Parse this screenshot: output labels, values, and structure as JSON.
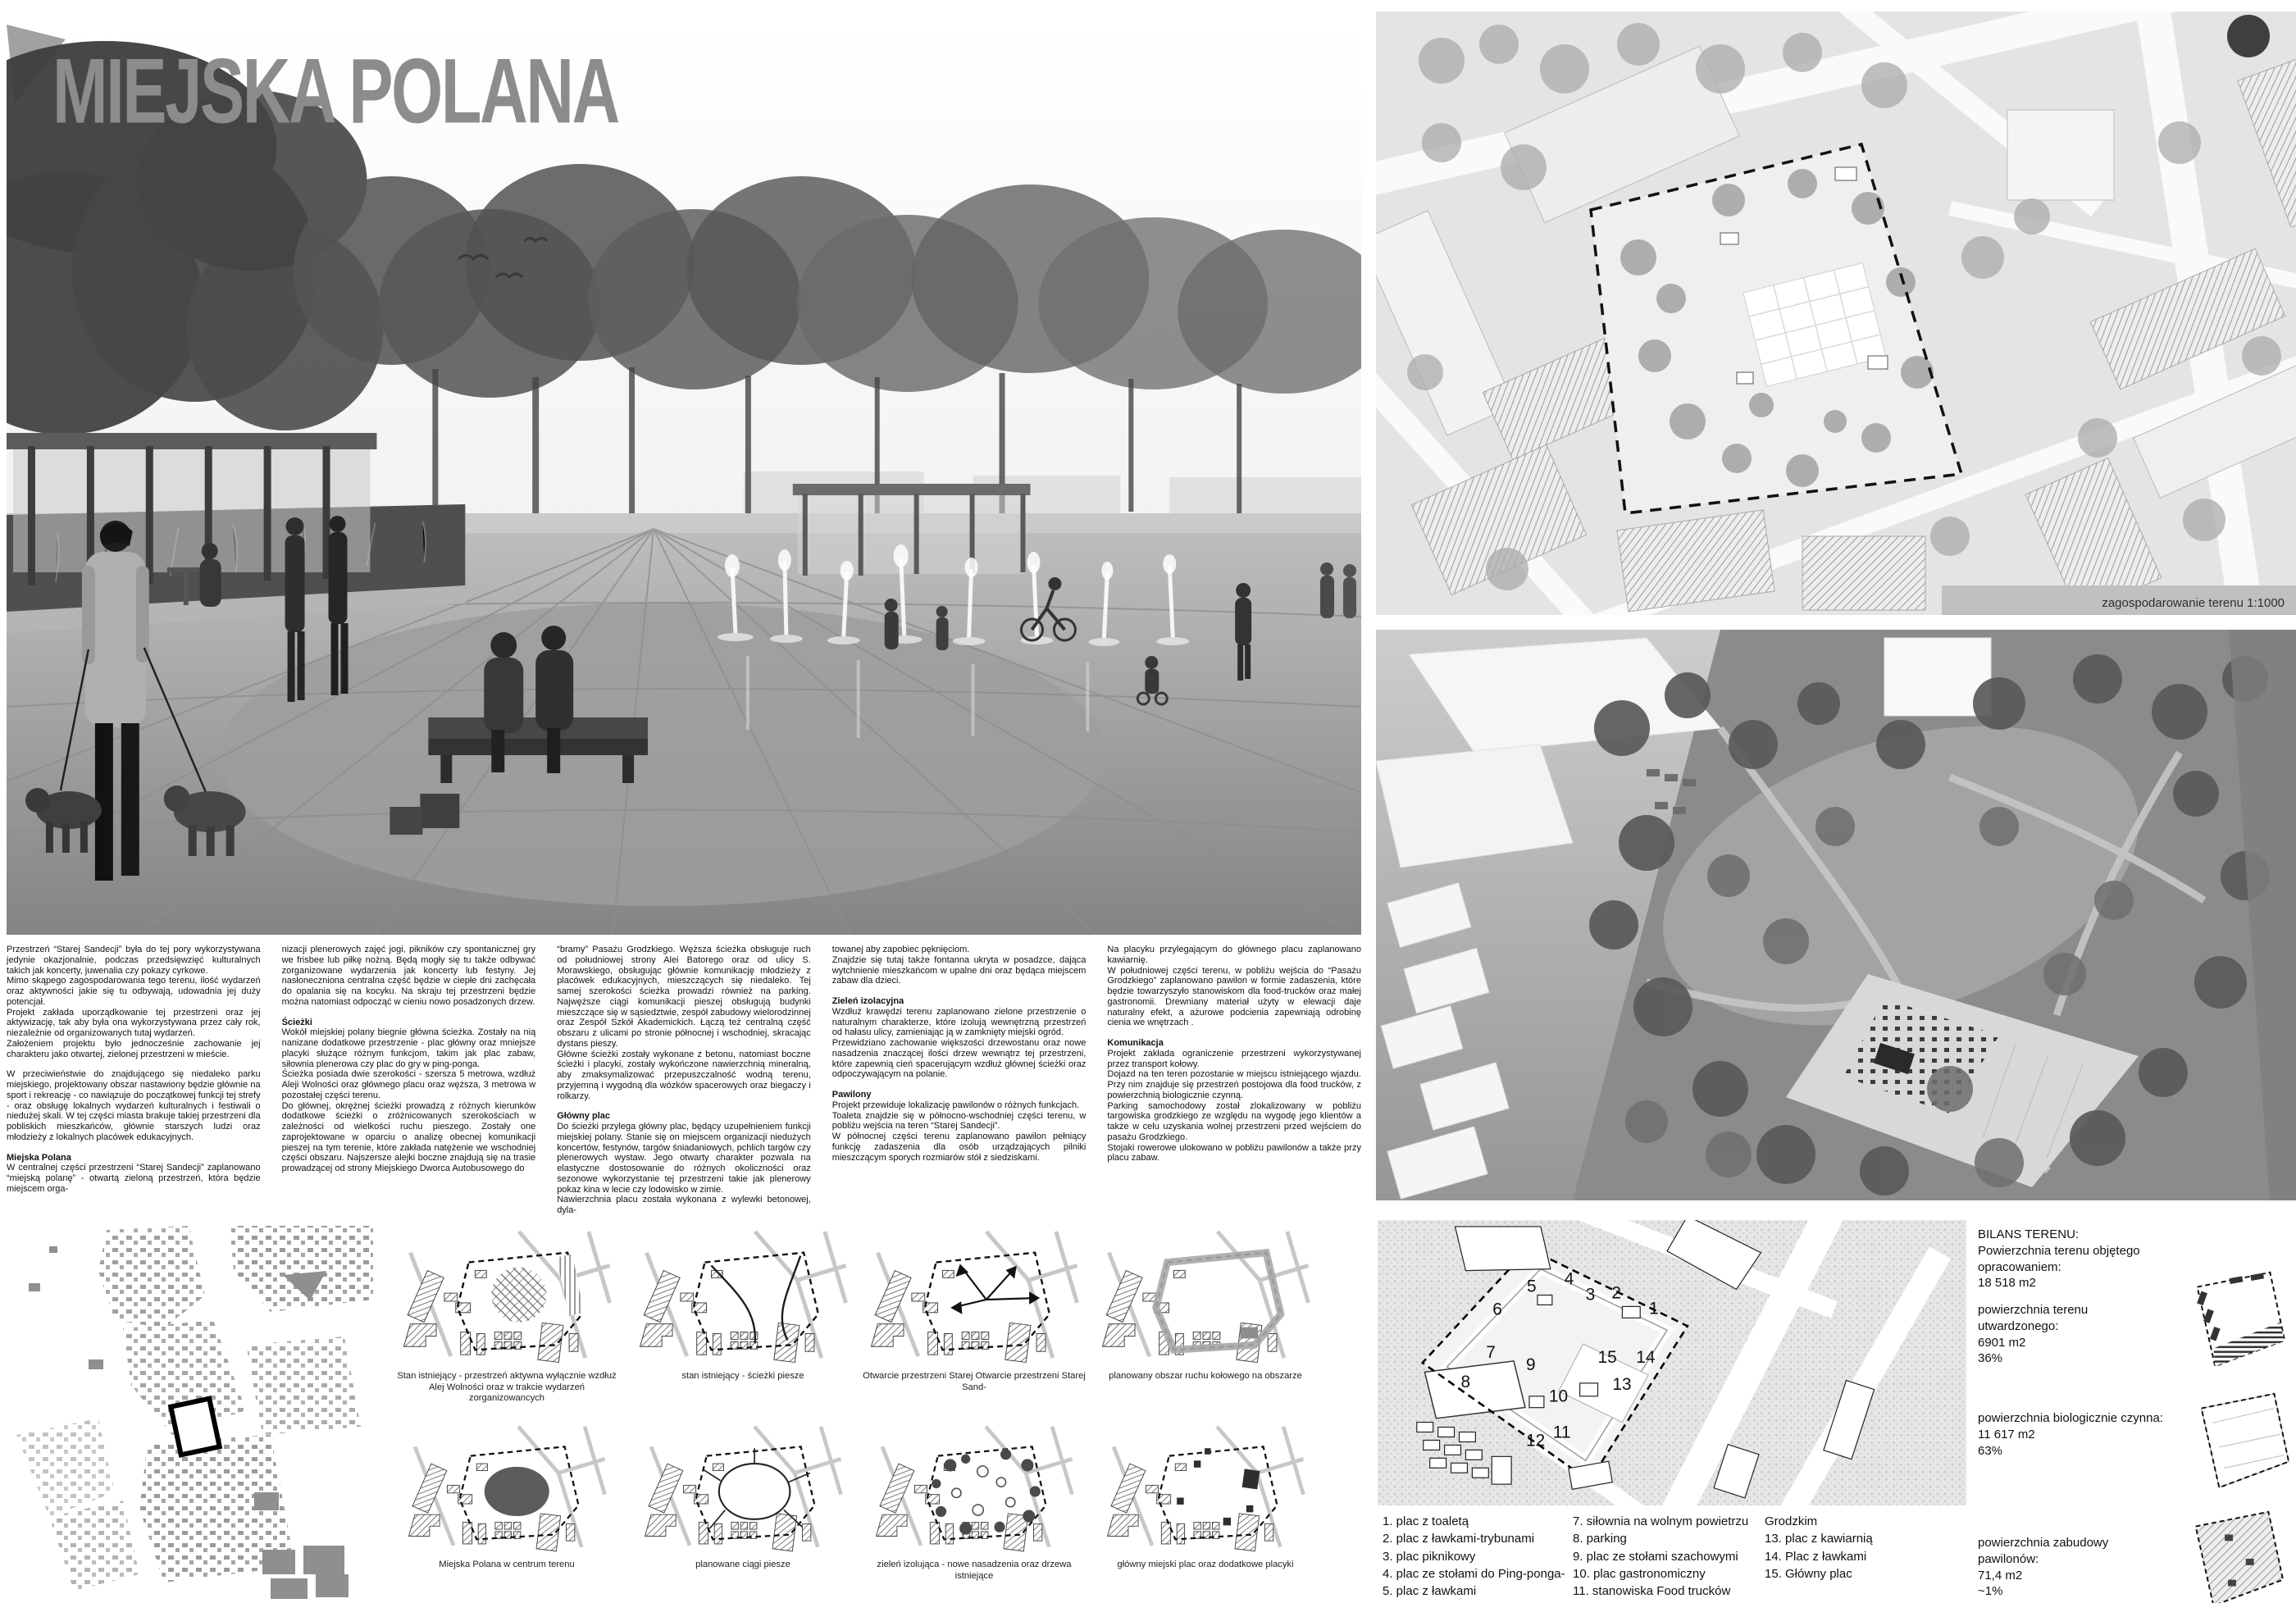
{
  "board": {
    "title": "MIEJSKA POLANA"
  },
  "narrative": {
    "col1": {
      "blocks": [
        {
          "text": "Przestrzeń “Starej Sandecji” była do tej pory wykorzystywana jedynie okazjonalnie, podczas przedsięwzięć kulturalnych takich jak koncerty, juwenalia czy pokazy cyrkowe."
        },
        {
          "text": "Mimo skąpego zagospodarowania tego terenu, ilość wydarzeń oraz aktywności jakie się tu odbywają, udowadnia jej duży potencjał."
        },
        {
          "text": "Projekt zakłada uporządkowanie tej przestrzeni oraz jej aktywizację, tak aby była ona wykorzystywana przez cały rok, niezależnie od organizowanych tutaj wydarzeń."
        },
        {
          "text": "Założeniem projektu było jednocześnie zachowanie jej charakteru jako otwartej, zielonej przestrzeni w mieście."
        },
        {
          "text": "W przeciwieństwie do znajdującego się niedaleko parku miejskiego, projektowany obszar nastawiony będzie głównie na sport i rekreację - co nawiązuje do początkowej funkcji tej strefy - oraz obsługę lokalnych wydarzeń kulturalnych i festiwali o niedużej skali. W tej części miasta brakuje takiej przestrzeni dla pobliskich mieszkańców, głównie starszych ludzi oraz młodzieży z lokalnych placówek edukacyjnych."
        },
        {
          "text": "Miejska Polana"
        },
        {
          "text": "W centralnej części przestrzeni “Starej Sandecji” zaplanowano “miejską polanę” - otwartą zieloną przestrzeń, która będzie miejscem orga-"
        }
      ]
    },
    "col2": {
      "blocks": [
        {
          "text": "nizacji plenerowych zajęć jogi, pikników czy spontanicznej gry we frisbee lub piłkę nożną. Będą mogły się tu także odbywać zorganizowane wydarzenia jak koncerty lub festyny. Jej nasłoneczniona centralna część będzie w ciepłe dni zachęcała do opalania się na kocyku. Na skraju tej przestrzeni będzie można natomiast odpocząć w cieniu nowo posadzonych drzew."
        },
        {
          "text": "Ścieżki"
        },
        {
          "text": "Wokół miejskiej polany biegnie główna ścieżka. Zostały na nią nanizane dodatkowe przestrzenie - plac główny oraz mniejsze placyki służące różnym funkcjom, takim jak plac zabaw, siłownia plenerowa czy plac do gry w ping-ponga."
        },
        {
          "text": "Ścieżka posiada dwie szerokości - szersza 5 metrowa, wzdłuż Aleji Wolności oraz głównego placu oraz węższa, 3 metrowa w pozostałej części terenu."
        },
        {
          "text": "Do głównej, okrężnej ścieżki prowadzą z różnych kierunków dodatkowe ścieżki o zróżnicowanych szerokościach w zależności od wielkości ruchu pieszego. Zostały one zaprojektowane w oparciu o analizę obecnej komunikacji pieszej na tym terenie, które zakłada natężenie we wschodniej części obszaru. Najszersze alejki boczne znajdują się na trasie prowadzącej od strony Miejskiego Dworca Autobusowego do"
        }
      ]
    },
    "col3": {
      "blocks": [
        {
          "text": "“bramy” Pasażu Grodzkiego. Węższa ścieżka obsługuje ruch od południowej strony Alei Batorego oraz od ulicy S. Morawskiego, obsługując głównie komunikację młodzieży z placówek edukacyjnych, mieszczących się niedaleko. Tej samej szerokości ścieżka prowadzi również na parking. Najwęższe ciągi komunikacji pieszej obsługują budynki mieszczące się w sąsiedztwie, zespół zabudowy wielorodzinnej oraz Zespół Szkół Akademickich. Łączą też centralną część obszaru z ulicami po stronie północnej i wschodniej, skracając dystans pieszy."
        },
        {
          "text": "Główne ścieżki zostały wykonane z betonu, natomiast boczne ścieżki i placyki, zostały wykończone nawierzchnią mineralną, aby zmaksymalizować przepuszczalność wodną terenu, przyjemną i wygodną dla wózków spacerowych oraz biegaczy i rolkarzy."
        },
        {
          "text": "Główny plac"
        },
        {
          "text": "Do ścieżki przylega główny plac, będący uzupełnieniem funkcji miejskiej polany. Stanie się on miejscem organizacji niedużych koncertów, festynów, targów śniadaniowych, pchlich targów czy plenerowych wystaw. Jego otwarty charakter pozwala na elastyczne dostosowanie do różnych okoliczności oraz sezonowe wykorzystanie tej przestrzeni takie jak plenerowy pokaz kina w lecie czy lodowisko w zimie."
        },
        {
          "text": "Nawierzchnia placu została wykonana z wylewki betonowej, dyla-"
        }
      ]
    },
    "col4": {
      "blocks": [
        {
          "text": "towanej aby zapobiec pęknięciom."
        },
        {
          "text": "Znajdzie się tutaj także fontanna ukryta w posadzce, dająca wytchnienie mieszkańcom w upalne dni oraz będąca miejscem zabaw dla dzieci."
        },
        {
          "text": "Zieleń izolacyjna"
        },
        {
          "text": "Wzdłuż krawędzi terenu  zaplanowano zielone przestrzenie o naturalnym charakterze, które izolują wewnętrzną przestrzeń od hałasu ulicy, zamieniając ją w zamknięty miejski ogród."
        },
        {
          "text": "Przewidziano zachowanie większości drzewostanu oraz nowe nasadzenia znaczącej ilości drzew wewnątrz tej przestrzeni, które zapewnią cień spacerującym wzdłuż głównej ścieżki oraz odpoczywającym na polanie."
        },
        {
          "text": "Pawilony"
        },
        {
          "text": "Projekt przewiduje lokalizację pawilonów o różnych funkcjach."
        },
        {
          "text": "Toaleta znajdzie się w północno-wschodniej części terenu, w pobliżu wejścia na teren “Starej Sandecji”."
        },
        {
          "text": "W północnej części terenu zaplanowano pawilon pełniący funkcję zadaszenia dla osób urządzających pilniki mieszczącym sporych rozmiarów stół z siedziskami."
        }
      ]
    },
    "col5": {
      "blocks": [
        {
          "text": "Na placyku przylegającym do głównego placu zaplanowano kawiarnię."
        },
        {
          "text": "W południowej części terenu, w pobliżu wejścia do “Pasażu Grodzkiego” zaplanowano pawilon w formie zadaszenia, które będzie towarzyszyło stanowiskom dla food-trucków oraz małej gastronomii. Drewniany materiał użyty w elewacji daje naturalny efekt, a ażurowe podcienia zapewniają odrobinę cienia we wnętrzach ."
        },
        {
          "text": "Komunikacja"
        },
        {
          "text": "Projekt zakłada ograniczenie przestrzeni wykorzystywanej przez transport kołowy."
        },
        {
          "text": "Dojazd na ten teren pozostanie w miejscu istniejącego wjazdu. Przy nim znajduje się przestrzeń postojowa dla food trucków, z powierzchnią biologicznie czynną."
        },
        {
          "text": "Parking samochodowy został zlokalizowany  w pobliżu targowiska grodzkiego ze względu na wygodę jego klientów a także w celu uzyskania wolnej przestrzeni przed wejściem do pasażu Grodzkiego."
        },
        {
          "text": "Stojaki rowerowe ulokowano w pobliżu pawilonów a także przy placu zabaw."
        }
      ]
    }
  },
  "site_plan": {
    "label": "zagospodarowanie terenu 1:1000"
  },
  "diagrams": {
    "row1": [
      {
        "caption": "Stan istniejący - przestrzeń aktywna wyłącznie wzdłuż Alej Wolności oraz w trakcie wydarzeń zorganizowancych"
      },
      {
        "caption": "stan istniejący - ścieżki piesze"
      },
      {
        "caption": "Otwarcie przestrzeni Starej Otwarcie przestrzeni Starej Sand-"
      },
      {
        "caption": "planowany  obszar ruchu kołowego na obszarze"
      }
    ],
    "row2": [
      {
        "caption": "Miejska Polana w centrum terenu"
      },
      {
        "caption": "planowane ciągi piesze"
      },
      {
        "caption": "zieleń izolująca - nowe nasadzenia oraz drzewa istniejące"
      },
      {
        "caption": "główny miejski plac oraz dodatkowe placyki"
      }
    ]
  },
  "axon": {
    "numbers": [
      "1",
      "2",
      "3",
      "4",
      "5",
      "6",
      "7",
      "8",
      "9",
      "10",
      "11",
      "12",
      "13",
      "14",
      "15"
    ]
  },
  "legend": {
    "col1": [
      "1. plac z toaletą",
      "2. plac z ławkami-trybunami",
      "3. plac piknikowy",
      "4. plac ze stołami do Ping-ponga-",
      "5. plac z ławkami",
      "6. plac zabaw"
    ],
    "col2": [
      "7. siłownia na wolnym powietrzu",
      "8. parking",
      "9. plac ze stołami szachowymi",
      "10. plac gastronomiczny",
      "11. stanowiska Food trucków",
      "12. plac wejściowy przed Pasażem"
    ],
    "col3": [
      "Grodzkim",
      "13. plac z kawiarnią",
      "14. Plac z ławkami",
      "15. Główny plac"
    ]
  },
  "bilans": {
    "title": "BILANS TERENU:",
    "items": [
      {
        "label": "Powierzchnia terenu objętego opracowaniem:",
        "value": "18 518 m2",
        "pct": ""
      },
      {
        "label": "powierzchnia terenu utwardzonego:",
        "value": "6901 m2",
        "pct": "36%"
      },
      {
        "label": "powierzchnia biologicznie czynna:",
        "value": "11 617 m2",
        "pct": "63%"
      },
      {
        "label": "powierzchnia zabudowy pawilonów:",
        "value": "71,4 m2",
        "pct": "~1%"
      }
    ]
  },
  "colors": {
    "title_gray": "#8c8c8c",
    "board_bg": "#ffffff",
    "plan_bg": "#e4e4e4",
    "label_strip": "#c0c0c0",
    "ink": "#111111"
  }
}
